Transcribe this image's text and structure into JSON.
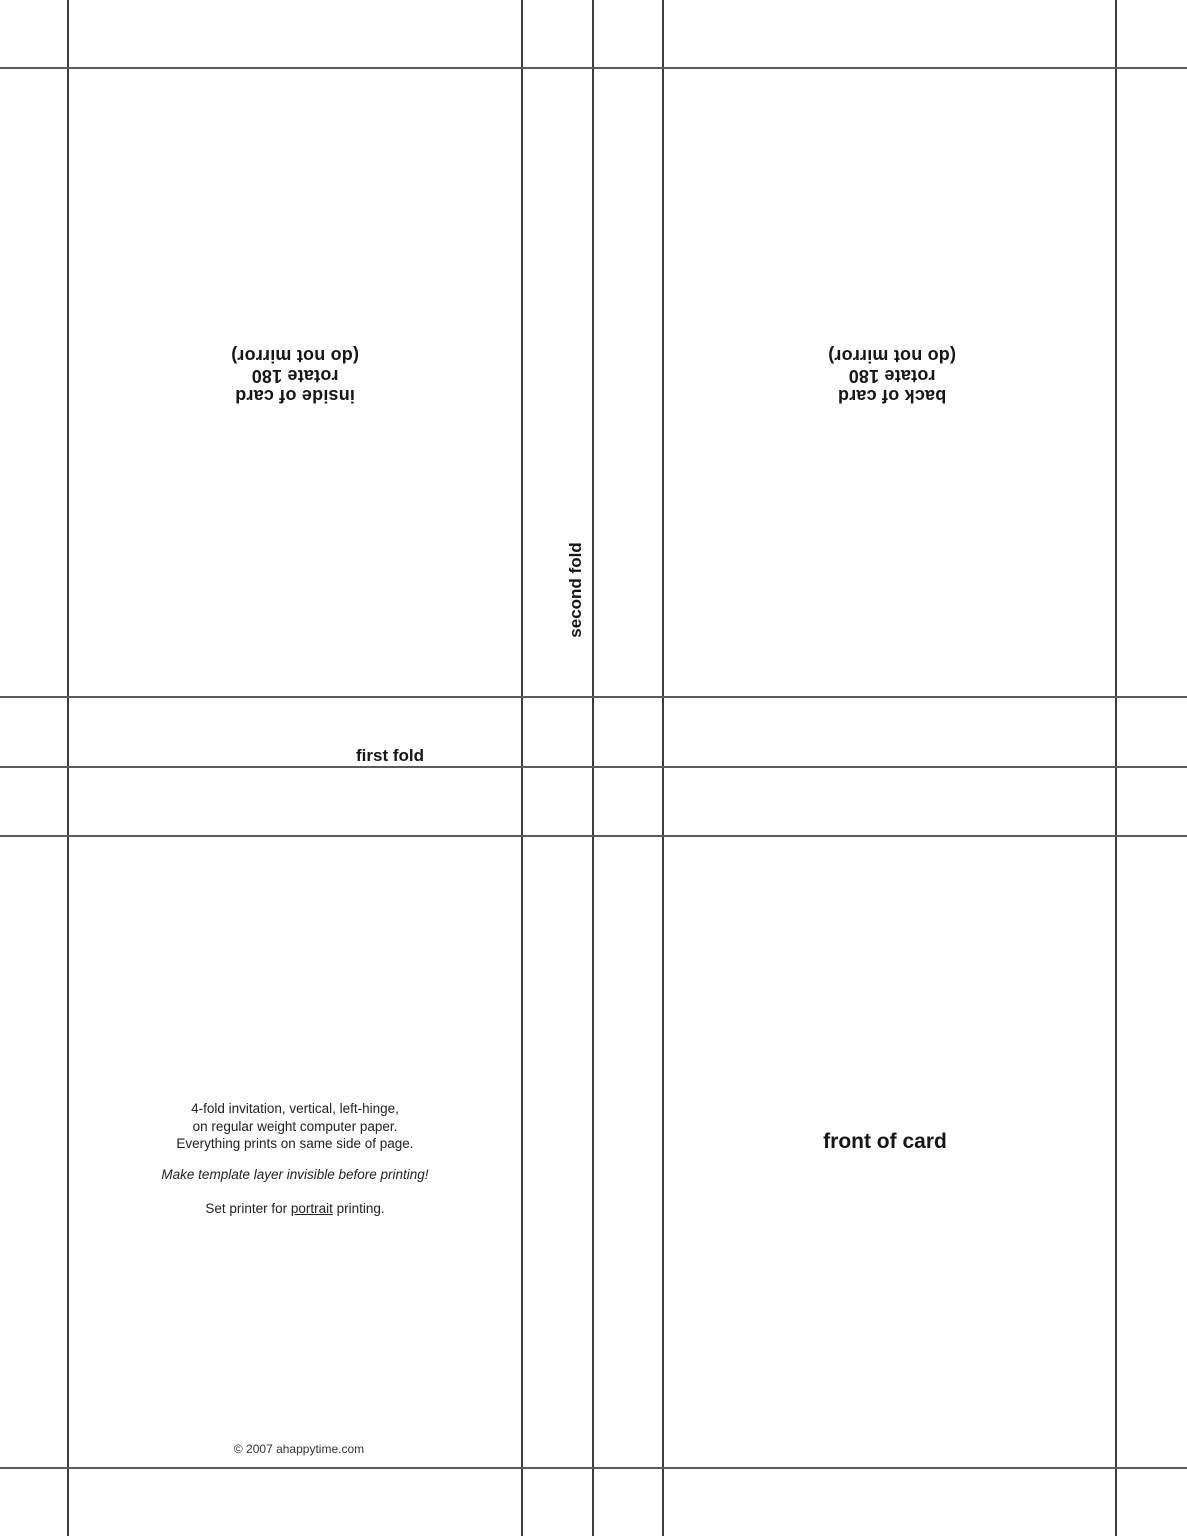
{
  "page": {
    "title": "4-fold invitation template",
    "background_color": "#ffffff",
    "vertical_line_color": "#3c3c3c",
    "horizontal_line_color": "#5c5c5c"
  },
  "panels": {
    "inside": {
      "lines": [
        "inside of card",
        "rotate 180",
        "(do not mirror)"
      ],
      "orientation": "rotated 180"
    },
    "back": {
      "lines": [
        "back of card",
        "rotate 180",
        "(do not mirror)"
      ],
      "orientation": "rotated 180"
    },
    "front": {
      "label": "front of card"
    }
  },
  "fold_labels": {
    "first": "first fold",
    "second": "second fold"
  },
  "instructions": {
    "paragraph": [
      "4-fold invitation, vertical, left-hinge,",
      "on regular weight computer paper.",
      "Everything prints on same side of page."
    ],
    "note": "Make template layer invisible before printing!",
    "printer": {
      "prefix": "Set printer for ",
      "underlined": "portrait",
      "suffix": " printing."
    }
  },
  "footer": {
    "copyright": "© 2007 ahappytime.com"
  }
}
